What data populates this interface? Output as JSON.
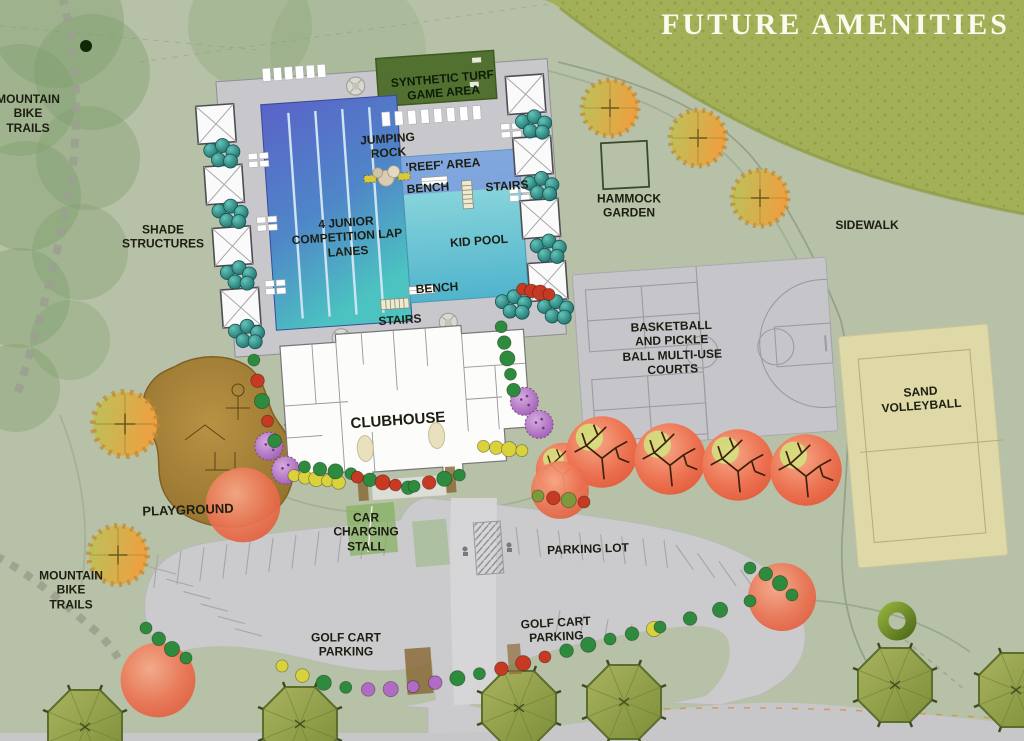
{
  "title": "FUTURE AMENITIES",
  "labels": {
    "mountain_bike_trails_nw": "MOUNTAIN\nBIKE\nTRAILS",
    "shade_structures": "SHADE\nSTRUCTURES",
    "synthetic_turf": "SYNTHETIC TURF\nGAME AREA",
    "jumping_rock": "JUMPING\nROCK",
    "reef_area": "'REEF' AREA",
    "bench_upper": "BENCH",
    "stairs_upper": "STAIRS",
    "lap_lanes": "4 JUNIOR\nCOMPETITION LAP\nLANES",
    "kid_pool": "KID POOL",
    "bench_lower": "BENCH",
    "stairs_lower": "STAIRS",
    "hammock_garden": "HAMMOCK\nGARDEN",
    "sidewalk": "SIDEWALK",
    "basketball_courts": "BASKETBALL\nAND PICKLE\nBALL MULTI-USE\nCOURTS",
    "sand_volleyball": "SAND\nVOLLEYBALL",
    "clubhouse": "CLUBHOUSE",
    "playground": "PLAYGROUND",
    "mountain_bike_trails_sw": "MOUNTAIN\nBIKE\nTRAILS",
    "car_charging_stall": "CAR\nCHARGING\nSTALL",
    "parking_lot": "PARKING LOT",
    "golf_cart_parking_left": "GOLF CART\nPARKING",
    "golf_cart_parking_right": "GOLF CART\nPARKING"
  },
  "colors": {
    "background": "#b7c1a7",
    "olive_hillside": "#a3b057",
    "pool_deck": "#c8c7cb",
    "parking": "#cbcbce",
    "road": "#c7c7ca",
    "pool_deep": "#5a63c8",
    "pool_shallow": "#4cc3c0",
    "kid_pool": "#8fd8da",
    "turf_green": "#52702f",
    "sand": "#ded9a6",
    "playground_brown": "#a8813a",
    "red_tree": "#ec7352",
    "orange_tree": "#e0933c",
    "palm_tree": "#93a24c",
    "label_text": "#1d1d12",
    "title_text": "#fafaef",
    "shrubs": {
      "g": "#2e8b3d",
      "y": "#d9d23c",
      "p": "#b06cc4",
      "r": "#c63a24",
      "t": "#2a7f80",
      "o": "#7c9a3c"
    }
  }
}
